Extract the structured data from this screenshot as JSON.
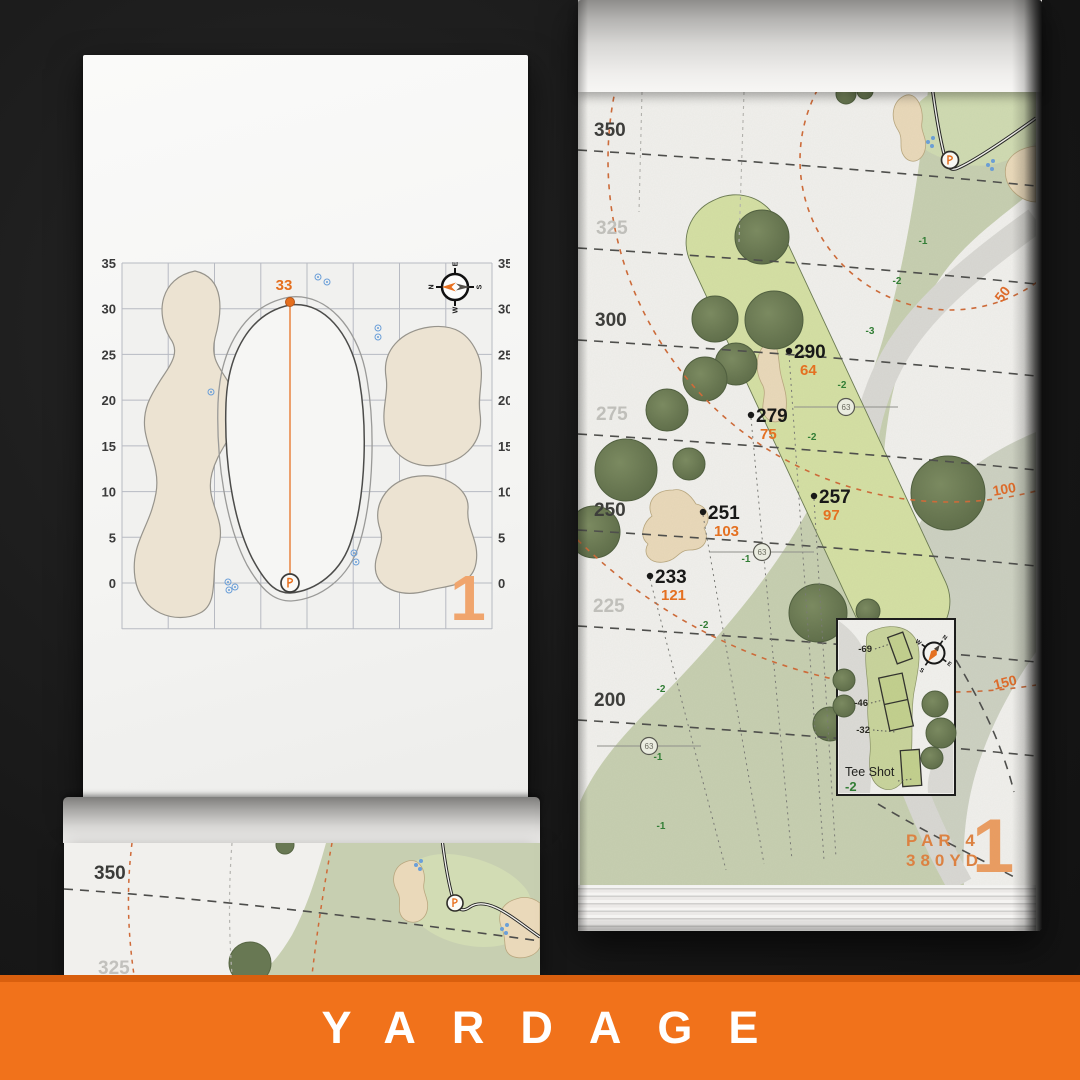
{
  "banner": {
    "label": "YARDAGE",
    "bg_color": "#F1721B",
    "text_color": "#FFFFFF"
  },
  "accent_orange": "#E8701F",
  "left_page": {
    "hole_number": "1",
    "green_depth": "33",
    "axis_ticks": [
      "35",
      "30",
      "25",
      "20",
      "15",
      "10",
      "5",
      "0"
    ],
    "compass": {
      "n": "N",
      "e": "E",
      "s": "S",
      "w": "W"
    }
  },
  "right_page": {
    "hole_number": "1",
    "par": "PAR 4",
    "yardage": "380YD",
    "distance_ticks": [
      {
        "label": "350",
        "strong": true
      },
      {
        "label": "325",
        "strong": false
      },
      {
        "label": "300",
        "strong": true
      },
      {
        "label": "275",
        "strong": false
      },
      {
        "label": "250",
        "strong": true
      },
      {
        "label": "225",
        "strong": false
      },
      {
        "label": "200",
        "strong": true
      }
    ],
    "carry_points": [
      {
        "carry": "290",
        "to_green": "64"
      },
      {
        "carry": "279",
        "to_green": "75"
      },
      {
        "carry": "257",
        "to_green": "97"
      },
      {
        "carry": "251",
        "to_green": "103"
      },
      {
        "carry": "233",
        "to_green": "121"
      }
    ],
    "arc_labels": [
      "50",
      "100",
      "150"
    ],
    "elevation_labels": [
      "-1",
      "-2",
      "-3",
      "-2",
      "-2",
      "-1",
      "-2",
      "-2",
      "-1",
      "-1"
    ],
    "sprinkler_markers": [
      "63",
      "63",
      "63"
    ],
    "tee_inset": {
      "title": "Tee Shot",
      "elevation": "-2",
      "tee_offsets": [
        "-69",
        "-46",
        "-32"
      ],
      "compass": {
        "n": "N",
        "e": "E",
        "s": "S",
        "w": "W"
      }
    }
  },
  "bottom_page": {
    "distance_ticks": [
      "350",
      "325"
    ]
  }
}
